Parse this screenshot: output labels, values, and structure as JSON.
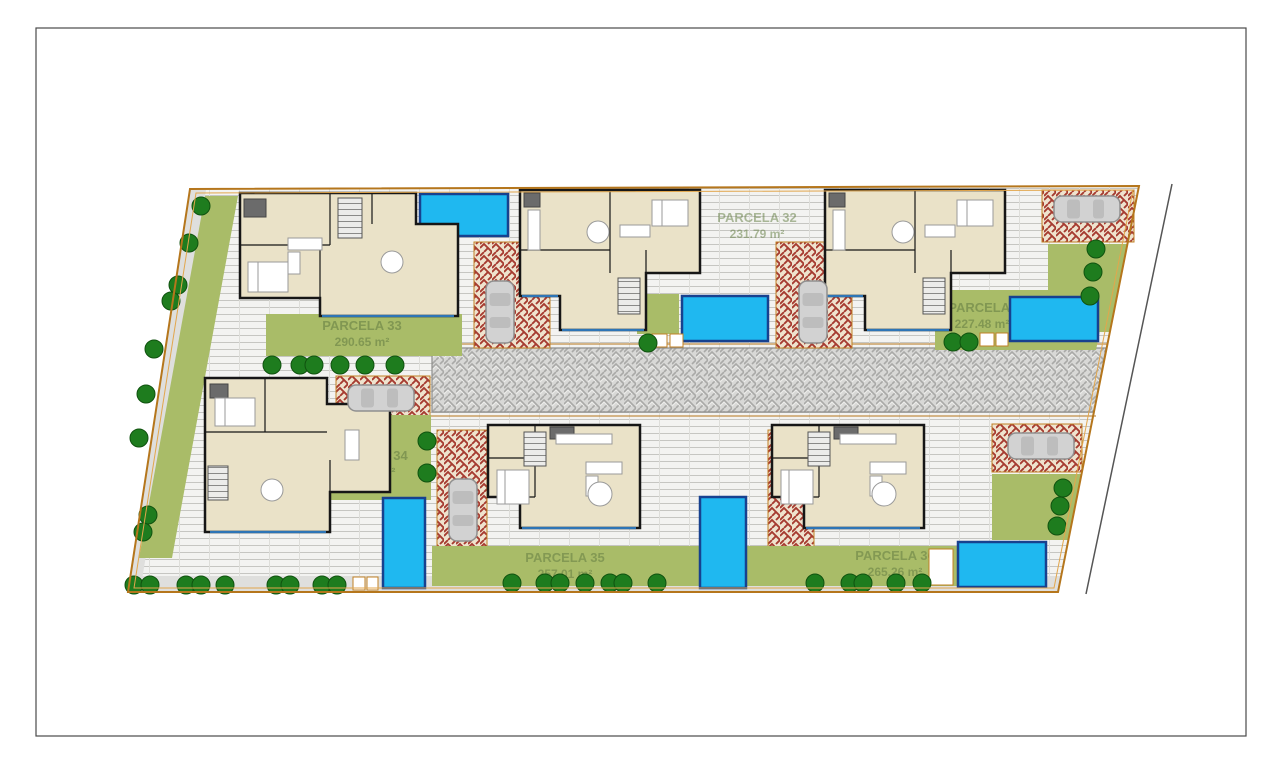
{
  "plan": {
    "parcels": [
      {
        "id": "31",
        "name": "PARCELA 31",
        "area": "227.48 m²"
      },
      {
        "id": "32",
        "name": "PARCELA 32",
        "area": "231.79 m²"
      },
      {
        "id": "33",
        "name": "PARCELA 33",
        "area": "290.65 m²"
      },
      {
        "id": "34",
        "name": "PARCELA 34",
        "area": "301.94 m²"
      },
      {
        "id": "35",
        "name": "PARCELA 35",
        "area": "257.01 m²"
      },
      {
        "id": "36",
        "name": "PARCELA 36",
        "area": "265.26 m²"
      }
    ],
    "colors": {
      "pool": "#1FB8F0",
      "pool_border": "#17418F",
      "lawn": "#A9BC68",
      "tree": "#1E7C1E",
      "driveway_red": "#A63B30",
      "road_gray": "#D8D8D6",
      "boundary_orange": "#B5761C",
      "wall": "#161616",
      "label_text": "#7D9450"
    }
  }
}
